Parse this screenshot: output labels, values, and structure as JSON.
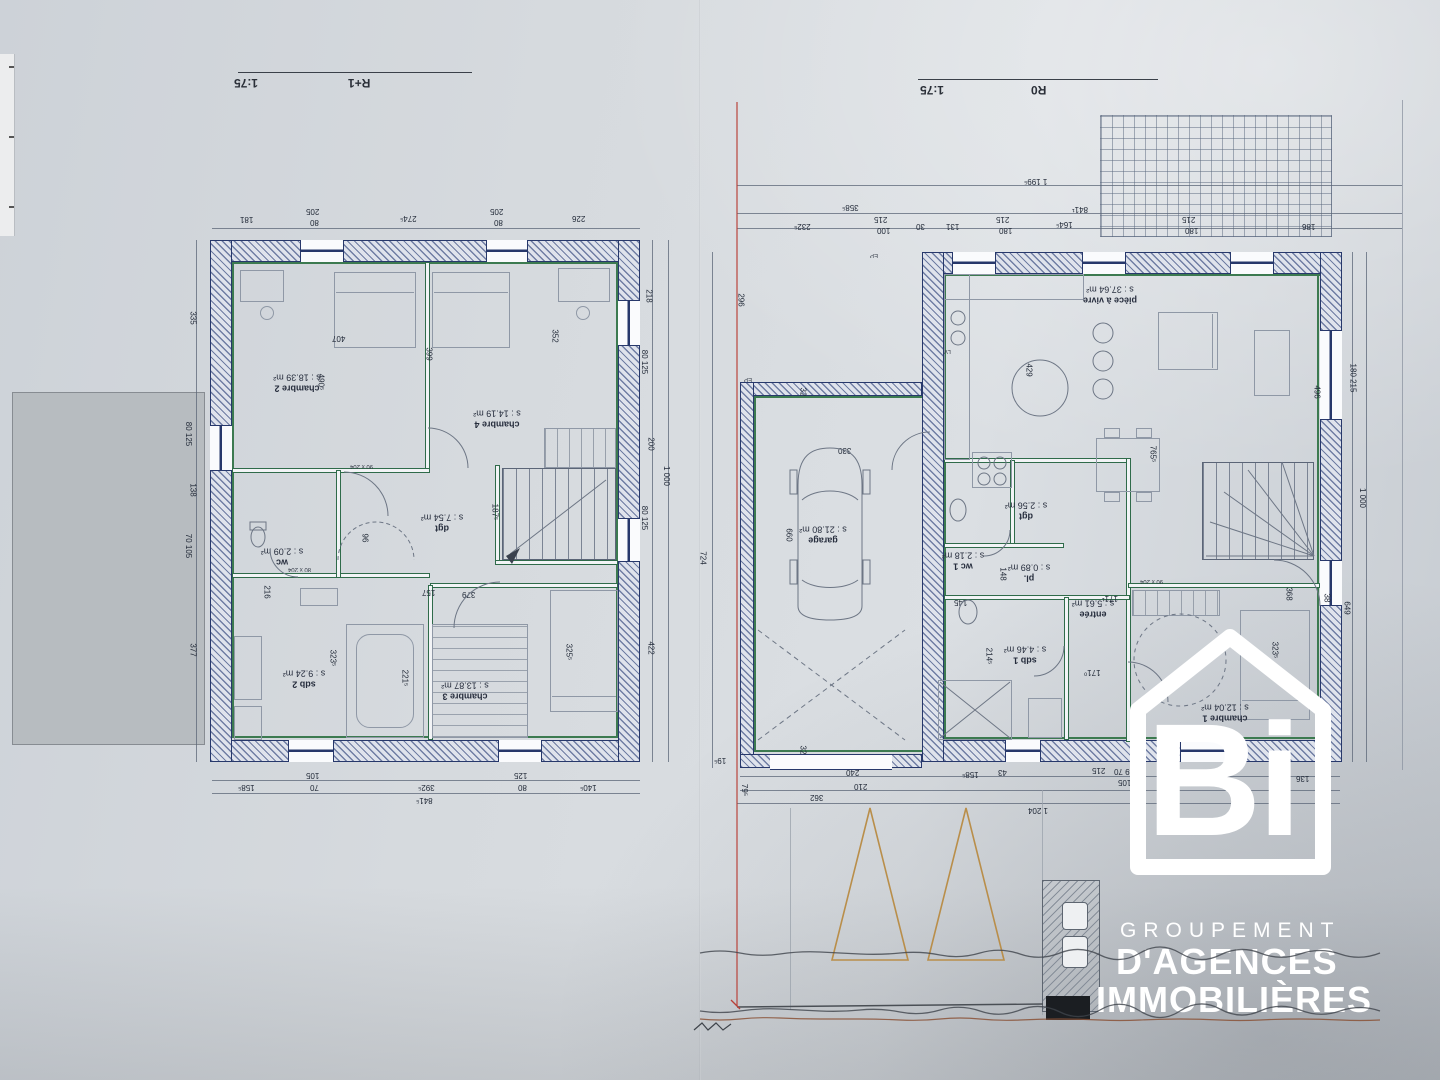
{
  "sheet": {
    "left_title": "R+1",
    "left_scale": "1:75",
    "right_title": "R0",
    "right_scale": "1:75"
  },
  "logo": {
    "monogram": "Bi",
    "line1": "GROUPEMENT",
    "line2": "D'AGENCES",
    "line3": "IMMOBILIÈRES"
  },
  "r1": {
    "rooms": [
      {
        "name": "chambre 2",
        "area": "s : 18.39 m²"
      },
      {
        "name": "chambre 4",
        "area": "s : 14.19 m²"
      },
      {
        "name": "dgt",
        "area": "s : 7.54 m²"
      },
      {
        "name": "wc",
        "area": "s : 2.09 m²"
      },
      {
        "name": "sdb 2",
        "area": "s : 9.24 m²"
      },
      {
        "name": "chambre 3",
        "area": "s : 13.87 m²"
      }
    ],
    "dims_top": [
      "181",
      "205",
      "80",
      "274⁵",
      "205",
      "80",
      "226"
    ],
    "dims_bottom": [
      "158⁵",
      "105",
      "70",
      "392⁵",
      "125",
      "80",
      "140⁵"
    ],
    "dims_bottom_total": "841⁵",
    "dims_left": [
      "335",
      "80 125",
      "138",
      "70 105",
      "377"
    ],
    "dims_right": [
      "218",
      "80 125",
      "200",
      "80 125",
      "422"
    ],
    "dims_right_total": "1 000",
    "interior_dims": [
      "407",
      "399",
      "352",
      "490⁵",
      "187⁵",
      "96",
      "379",
      "157",
      "323⁵",
      "221⁵",
      "325⁵",
      "216"
    ],
    "door_tags": [
      "90 x 204",
      "80 x 204"
    ]
  },
  "r0": {
    "rooms": [
      {
        "name": "pièce à vivre",
        "area": "s : 37.64 m²"
      },
      {
        "name": "garage",
        "area": "s : 21.80 m²"
      },
      {
        "name": "dgt",
        "area": "s : 2.56 m²"
      },
      {
        "name": "wc 1",
        "area": "s : 2.18 m²"
      },
      {
        "name": "pl.",
        "area": "s : 0.89 m²"
      },
      {
        "name": "sdb 1",
        "area": "s : 4.46 m²"
      },
      {
        "name": "entrée",
        "area": "s : 5.61 m²"
      },
      {
        "name": "chambre 1",
        "area": "s : 12.04 m²"
      }
    ],
    "dims_top": [
      "232⁵",
      "215",
      "100",
      "30",
      "131",
      "215",
      "180",
      "164⁵",
      "215",
      "180",
      "186"
    ],
    "dims_top_mid": [
      "358⁵",
      "841¹"
    ],
    "dims_top_total": "1 199⁵",
    "dims_left": [
      "296",
      "724",
      "19⁵",
      "32",
      "32"
    ],
    "dims_right": [
      "180 215",
      "1 000",
      "649",
      "38",
      "368"
    ],
    "dims_bottom": [
      "79⁵",
      "240",
      "210",
      "362",
      "158⁵",
      "43",
      "215",
      "149 70",
      "105",
      "1 204",
      "136"
    ],
    "interior_dims": [
      "429",
      "660",
      "765⁵",
      "496",
      "148",
      "145",
      "214⁵",
      "171¹",
      "171⁰",
      "323⁵",
      "330"
    ],
    "appliance_labels": [
      "LV"
    ],
    "ep_labels": [
      "EP",
      "EP"
    ],
    "door_tags": [
      "90 x 204"
    ]
  }
}
